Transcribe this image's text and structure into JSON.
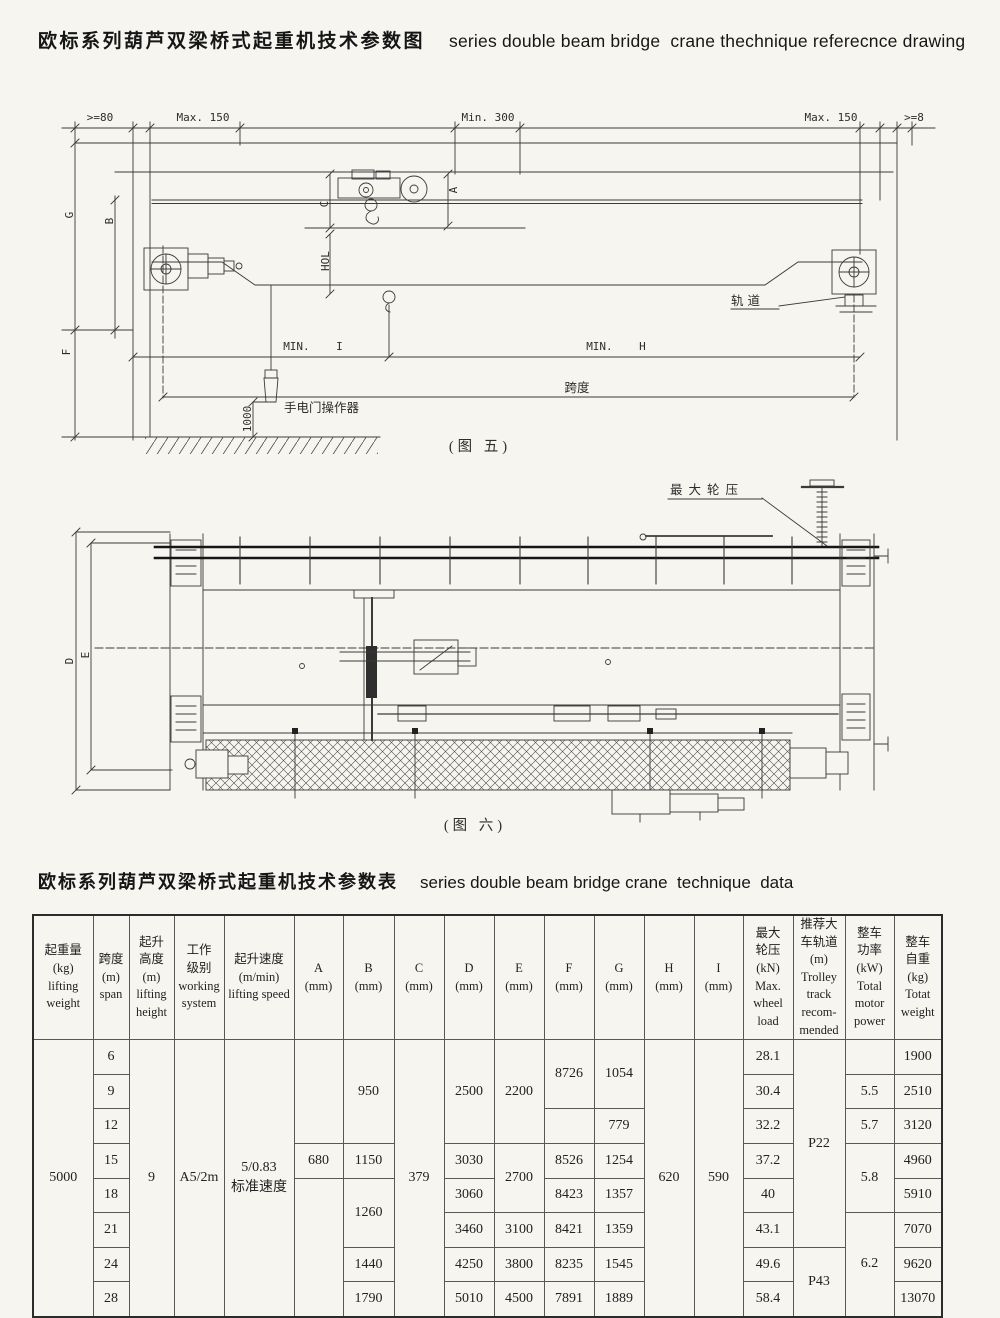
{
  "title": {
    "zh": "欧标系列葫芦双梁桥式起重机技术参数图",
    "en": "series double beam bridge  crane thechnique referecnce drawing"
  },
  "figure5": {
    "caption": "(图 五)",
    "dims": {
      "ge80": ">=80",
      "max150_l": "Max. 150",
      "min300": "Min. 300",
      "max150_r": "Max. 150",
      "ge8": ">=8",
      "g": "G",
      "b": "B",
      "f": "F",
      "c": "C",
      "a": "A",
      "hol": "HOL",
      "rail": "轨道",
      "min_i": "MIN.    I",
      "min_h": "MIN.    H",
      "span": "跨度",
      "pendant": "手电门操作器",
      "h1000": "1000"
    }
  },
  "figure6": {
    "caption": "(图 六)",
    "dims": {
      "max_wheel": "最大轮压",
      "d": "D",
      "e": "E"
    }
  },
  "table": {
    "title_zh": "欧标系列葫芦双梁桥式起重机技术参数表",
    "title_en": "series double beam bridge crane  technique  data",
    "headers": [
      "起重量\n(kg)\nlifting\nweight",
      "跨度\n(m)\nspan",
      "起升\n高度\n(m)\nlifting\nheight",
      "工作\n级别\nworking\nsystem",
      "起升速度\n(m/min)\nlifting speed",
      "A\n(mm)",
      "B\n(mm)",
      "C\n(mm)",
      "D\n(mm)",
      "E\n(mm)",
      "F\n(mm)",
      "G\n(mm)",
      "H\n(mm)",
      "I\n(mm)",
      "最大\n轮压\n(kN)\nMax.\nwheel\nload",
      "推荐大\n车轨道\n(m)\nTrolley\ntrack\nrecom-\nmended",
      "整车\n功率\n(kW)\nTotal\nmotor\npower",
      "整车\n自重\n(kg)\nTotat\nweight"
    ],
    "body": {
      "lifting_weight": "5000",
      "span": [
        "6",
        "9",
        "12",
        "15",
        "18",
        "21",
        "24",
        "28"
      ],
      "lifting_height": "9",
      "working_system": "A5/2m",
      "lifting_speed": "5/0.83\n标准速度",
      "A": {
        "r15": "680"
      },
      "B": {
        "r6_12": "950",
        "r15": "1150",
        "r18_21": "1260",
        "r24": "1440",
        "r28": "1790"
      },
      "C": "379",
      "D": {
        "r6_12": "2500",
        "r15": "3030",
        "r18": "3060",
        "r21": "3460",
        "r24": "4250",
        "r28": "5010"
      },
      "E": {
        "r6_12": "2200",
        "r15_18": "2700",
        "r21": "3100",
        "r24": "3800",
        "r28": "4500"
      },
      "F": {
        "r6_9": "8726",
        "r15": "8526",
        "r18": "8423",
        "r21": "8421",
        "r24": "8235",
        "r28": "7891"
      },
      "G": {
        "r6_9": "1054",
        "r12": "779",
        "r15": "1254",
        "r18": "1357",
        "r21": "1359",
        "r24": "1545",
        "r28": "1889"
      },
      "H": "620",
      "I": "590",
      "max_wheel_load": [
        "28.1",
        "30.4",
        "32.2",
        "37.2",
        "40",
        "43.1",
        "49.6",
        "58.4"
      ],
      "track": {
        "r6_21": "P22",
        "r24_28": "P43"
      },
      "motor_power": {
        "r9": "5.5",
        "r12": "5.7",
        "r15_18": "5.8",
        "r21_28": "6.2"
      },
      "total_weight": [
        "1900",
        "2510",
        "3120",
        "4960",
        "5910",
        "7070",
        "9620",
        "13070"
      ]
    }
  }
}
